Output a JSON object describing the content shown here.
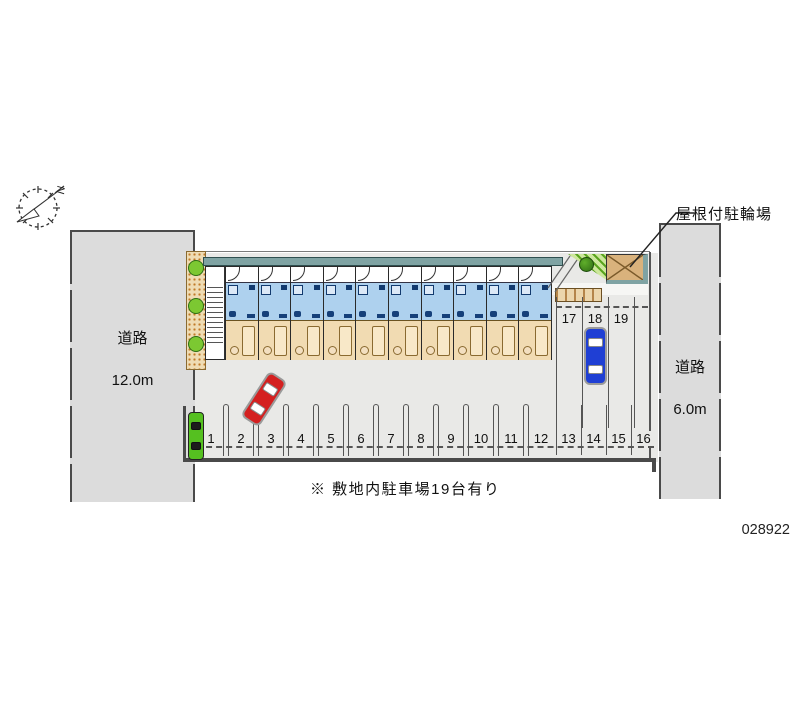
{
  "meta": {
    "plan_number": "028922"
  },
  "compass": {
    "label": "N"
  },
  "roads": {
    "left": {
      "name": "道路",
      "width": "12.0m"
    },
    "right": {
      "name": "道路",
      "width": "6.0m"
    }
  },
  "annotations": {
    "bicycle_shed_label": "屋根付駐輪場",
    "note": "※ 敷地内駐車場19台有り"
  },
  "parking": {
    "bottom_spaces": [
      "1",
      "2",
      "3",
      "4",
      "5",
      "6",
      "7",
      "8",
      "9",
      "10",
      "11",
      "12",
      "13",
      "14",
      "15",
      "16"
    ],
    "side_spaces": [
      "17",
      "18",
      "19"
    ],
    "total_note_count": "19"
  },
  "building": {
    "unit_count": 10
  },
  "colors": {
    "road": "#dcdcdc",
    "lot": "#e9e9e7",
    "roof_band": "#7fa3a3",
    "unit_wet": "#aed1ee",
    "unit_living": "#f1dbb2",
    "shed": "#d9b27c",
    "bush": "#7cc832",
    "car_red": "#d42020",
    "car_blue": "#1f3fd4",
    "car_green": "#55c020",
    "line": "#4a4a4a"
  }
}
